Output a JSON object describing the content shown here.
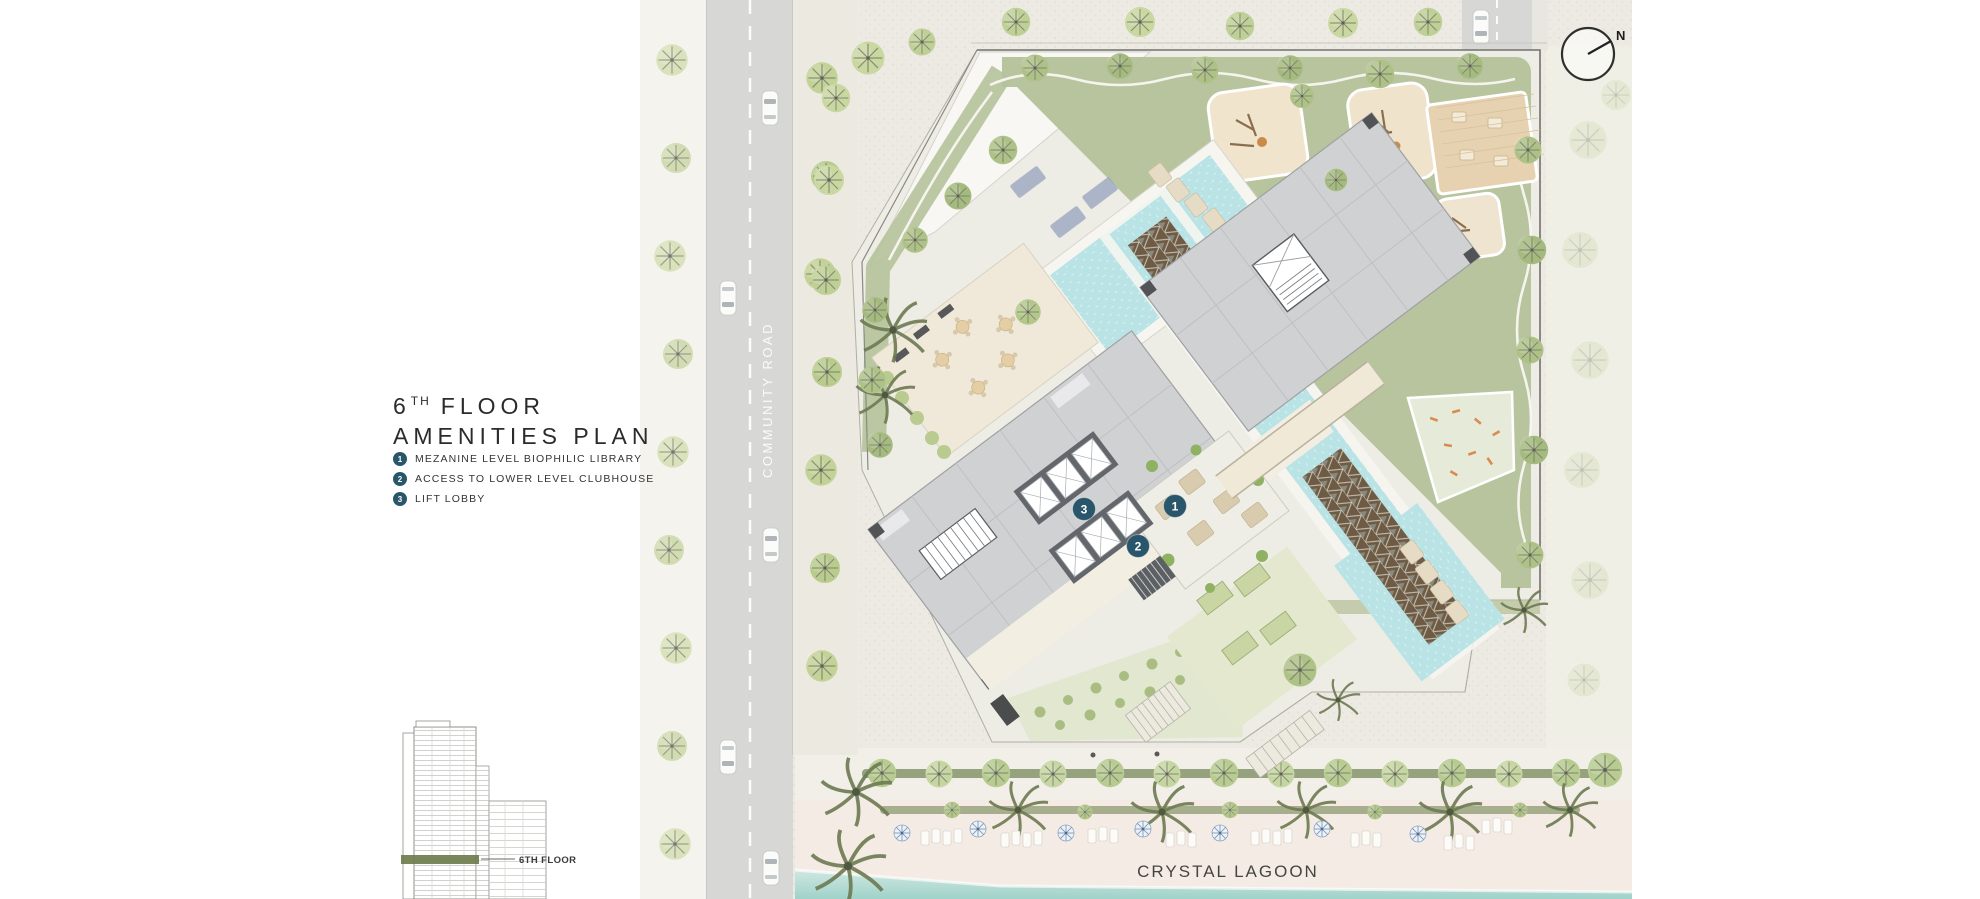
{
  "page": {
    "width": 1980,
    "height": 899
  },
  "title": {
    "floor_number": "6",
    "floor_ordinal": "TH",
    "floor_word": "FLOOR",
    "line2": "AMENITIES PLAN"
  },
  "legend": {
    "items": [
      {
        "num": "1",
        "label": "MEZANINE LEVEL BIOPHILIC LIBRARY"
      },
      {
        "num": "2",
        "label": "ACCESS TO LOWER LEVEL CLUBHOUSE"
      },
      {
        "num": "3",
        "label": "LIFT LOBBY"
      }
    ]
  },
  "elevation": {
    "label": "6TH FLOOR"
  },
  "plan": {
    "road_label": "COMMUNITY ROAD",
    "lagoon_label": "CRYSTAL LAGOON",
    "compass_label": "N",
    "markers": [
      {
        "num": "1"
      },
      {
        "num": "2"
      },
      {
        "num": "3"
      }
    ]
  },
  "colors": {
    "teal": "#2a566b",
    "sand": "#edeae3",
    "road": "#d7d8d6",
    "green": "#b5c29a",
    "water": "#b9e3e5",
    "lattice": "#6d5b46",
    "building": "#d0d1d3",
    "corridor": "#f2eee2",
    "lagoon": "#a9d8cf",
    "ink": "#2b2b2b"
  }
}
